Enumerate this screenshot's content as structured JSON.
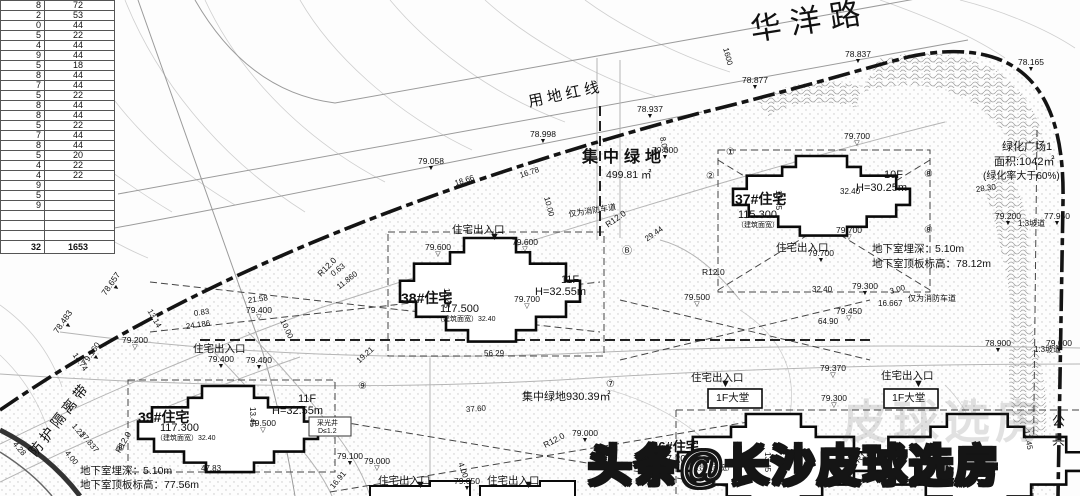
{
  "table": {
    "rows": [
      {
        "a": "8",
        "b": "72"
      },
      {
        "a": "2",
        "b": "53"
      },
      {
        "a": "0",
        "b": "44"
      },
      {
        "a": "5",
        "b": "22"
      },
      {
        "a": "4",
        "b": "44"
      },
      {
        "a": "9",
        "b": "44"
      },
      {
        "a": "5",
        "b": "18"
      },
      {
        "a": "8",
        "b": "44"
      },
      {
        "a": "7",
        "b": "44"
      },
      {
        "a": "5",
        "b": "22"
      },
      {
        "a": "8",
        "b": "44"
      },
      {
        "a": "8",
        "b": "44"
      },
      {
        "a": "5",
        "b": "22"
      },
      {
        "a": "7",
        "b": "44"
      },
      {
        "a": "8",
        "b": "44"
      },
      {
        "a": "5",
        "b": "20"
      },
      {
        "a": "4",
        "b": "22"
      },
      {
        "a": "4",
        "b": "22"
      },
      {
        "a": "9",
        "b": ""
      },
      {
        "a": "5",
        "b": ""
      },
      {
        "a": "9",
        "b": ""
      },
      {
        "a": "",
        "b": ""
      },
      {
        "a": "",
        "b": ""
      },
      {
        "a": "",
        "b": ""
      },
      {
        "a": "32",
        "b": "1653",
        "cls": "tt"
      }
    ]
  },
  "labels": [
    {
      "t": "华洋路",
      "x": 748,
      "y": 14,
      "s": 31,
      "rot": -9,
      "w": 9
    },
    {
      "t": "用地红线",
      "x": 527,
      "y": 95,
      "s": 15,
      "rot": -12,
      "w": 4
    },
    {
      "t": "防护隔离带",
      "x": 26,
      "y": 450,
      "s": 14,
      "rot": -52,
      "w": 4
    },
    {
      "t": "集中绿地",
      "x": 582,
      "y": 149,
      "s": 16,
      "w": 5,
      "cls": "bd"
    },
    {
      "t": "499.81 ㎡",
      "x": 606,
      "y": 170,
      "s": 10.5
    },
    {
      "t": "集中绿地930.39㎡",
      "x": 522,
      "y": 392,
      "s": 11
    },
    {
      "t": "绿化广场1",
      "x": 1002,
      "y": 142,
      "s": 11
    },
    {
      "t": "面积:1042㎡",
      "x": 994,
      "y": 157,
      "s": 11
    },
    {
      "t": "(绿化率大于60%)",
      "x": 983,
      "y": 172,
      "s": 10
    },
    {
      "t": "37#住宅",
      "x": 735,
      "y": 192,
      "s": 14,
      "cls": "bd"
    },
    {
      "t": "115.300",
      "x": 738,
      "y": 210,
      "s": 11
    },
    {
      "t": "（建筑面宽）",
      "x": 737,
      "y": 222,
      "s": 7
    },
    {
      "t": "10F",
      "x": 884,
      "y": 170,
      "s": 11
    },
    {
      "t": "H=30.25m",
      "x": 856,
      "y": 183,
      "s": 11
    },
    {
      "t": "38#住宅",
      "x": 401,
      "y": 291,
      "s": 14,
      "cls": "bd"
    },
    {
      "t": "117.500",
      "x": 440,
      "y": 304,
      "s": 11
    },
    {
      "t": "（建筑面宽）32.40",
      "x": 436,
      "y": 316,
      "s": 7
    },
    {
      "t": "11F",
      "x": 561,
      "y": 275,
      "s": 11
    },
    {
      "t": "H=32.55m",
      "x": 535,
      "y": 287,
      "s": 11
    },
    {
      "t": "39#住宅",
      "x": 138,
      "y": 410,
      "s": 14,
      "cls": "bd"
    },
    {
      "t": "117.300",
      "x": 160,
      "y": 423,
      "s": 11
    },
    {
      "t": "（建筑面宽）32.40",
      "x": 156,
      "y": 435,
      "s": 7
    },
    {
      "t": "11F",
      "x": 298,
      "y": 394,
      "s": 11
    },
    {
      "t": "H=32.55m",
      "x": 272,
      "y": 406,
      "s": 11
    },
    {
      "t": "36#住宅",
      "x": 651,
      "y": 440,
      "s": 13,
      "cls": "bd"
    },
    {
      "t": "117.200",
      "x": 656,
      "y": 455,
      "s": 10
    },
    {
      "t": "（建筑面宽）",
      "x": 692,
      "y": 465,
      "s": 7
    },
    {
      "t": "住宅出入口",
      "x": 452,
      "y": 225,
      "s": 10.5
    },
    {
      "t": "住宅出入口",
      "x": 776,
      "y": 243,
      "s": 10.5
    },
    {
      "t": "住宅出入口",
      "x": 691,
      "y": 373,
      "s": 10.5
    },
    {
      "t": "住宅出入口",
      "x": 881,
      "y": 371,
      "s": 10.5
    },
    {
      "t": "住宅出入口",
      "x": 378,
      "y": 476,
      "s": 10.5
    },
    {
      "t": "住宅出入口",
      "x": 487,
      "y": 476,
      "s": 10.5
    },
    {
      "t": "住宅出入口",
      "x": 193,
      "y": 344,
      "s": 10.5
    },
    {
      "t": "1F大堂",
      "x": 716,
      "y": 393,
      "s": 10.5
    },
    {
      "t": "1F大堂",
      "x": 892,
      "y": 393,
      "s": 10.5
    },
    {
      "t": "地下室埋深：5.10m",
      "x": 872,
      "y": 244,
      "s": 10.5
    },
    {
      "t": "地下室顶板标高：78.12m",
      "x": 872,
      "y": 259,
      "s": 10.5
    },
    {
      "t": "地下室埋深：5.10m",
      "x": 80,
      "y": 466,
      "s": 10.5
    },
    {
      "t": "地下室顶板标高：77.56m",
      "x": 80,
      "y": 480,
      "s": 10.5
    },
    {
      "t": "仅为消防车道",
      "x": 568,
      "y": 211,
      "s": 8,
      "rot": -9
    },
    {
      "t": "仅为消防车道",
      "x": 908,
      "y": 295,
      "s": 8
    },
    {
      "t": "采光井",
      "x": 317,
      "y": 420,
      "s": 7
    },
    {
      "t": "D≤1.2",
      "x": 318,
      "y": 428,
      "s": 7
    },
    {
      "t": "公共",
      "x": 1050,
      "y": 414,
      "s": 13,
      "w": 6,
      "cls": "v"
    },
    {
      "t": "1:3坡道",
      "x": 1018,
      "y": 220,
      "s": 8
    },
    {
      "t": "1:3坡道",
      "x": 1034,
      "y": 346,
      "s": 8
    },
    {
      "t": "R12.0",
      "x": 604,
      "y": 222,
      "s": 8.5,
      "rot": -35
    },
    {
      "t": "R12.0",
      "x": 702,
      "y": 268,
      "s": 8.5
    },
    {
      "t": "R12.0",
      "x": 542,
      "y": 442,
      "s": 8.5,
      "rot": -28
    },
    {
      "t": "R12.0",
      "x": 854,
      "y": 458,
      "s": 8.5,
      "rot": -40
    },
    {
      "t": "R12.0",
      "x": 316,
      "y": 272,
      "s": 8.5,
      "rot": -45
    },
    {
      "t": "R12.0",
      "x": 114,
      "y": 450,
      "s": 8.5,
      "rot": -60
    }
  ],
  "markers": [
    {
      "v": "78.837",
      "x": 845,
      "y": 50,
      "g": "▼"
    },
    {
      "v": "78.877",
      "x": 742,
      "y": 76,
      "g": "▼"
    },
    {
      "v": "78.165",
      "x": 1018,
      "y": 58,
      "g": "▼"
    },
    {
      "v": "78.937",
      "x": 637,
      "y": 105,
      "g": "▼"
    },
    {
      "v": "78.998",
      "x": 530,
      "y": 130,
      "g": "▼"
    },
    {
      "v": "79.058",
      "x": 418,
      "y": 157,
      "g": "▼"
    },
    {
      "v": "78.657",
      "x": 100,
      "y": 292,
      "g": "▼",
      "rot": -55
    },
    {
      "v": "78.483",
      "x": 52,
      "y": 330,
      "g": "▼",
      "rot": -55
    },
    {
      "v": "79.160",
      "x": 80,
      "y": 362,
      "g": "▼",
      "rot": -55
    },
    {
      "v": "79.200",
      "x": 122,
      "y": 336,
      "g": "▽"
    },
    {
      "v": "79.700",
      "x": 844,
      "y": 132,
      "g": "▽"
    },
    {
      "v": "79.600",
      "x": 652,
      "y": 146,
      "g": "▼"
    },
    {
      "v": "79.600",
      "x": 425,
      "y": 243,
      "g": "▽"
    },
    {
      "v": "79.600",
      "x": 512,
      "y": 238,
      "g": "▽"
    },
    {
      "v": "79.700",
      "x": 836,
      "y": 226,
      "g": "▽"
    },
    {
      "v": "79.700",
      "x": 808,
      "y": 249,
      "g": "▼"
    },
    {
      "v": "79.700",
      "x": 514,
      "y": 295,
      "g": "▽"
    },
    {
      "v": "79.500",
      "x": 684,
      "y": 293,
      "g": "▽"
    },
    {
      "v": "79.300",
      "x": 852,
      "y": 282,
      "g": "▼"
    },
    {
      "v": "79.450",
      "x": 836,
      "y": 307,
      "g": "▽"
    },
    {
      "v": "79.370",
      "x": 820,
      "y": 364,
      "g": "▽"
    },
    {
      "v": "79.300",
      "x": 821,
      "y": 394,
      "g": "▽"
    },
    {
      "v": "79.400",
      "x": 246,
      "y": 306,
      "g": "▽"
    },
    {
      "v": "79.400",
      "x": 208,
      "y": 355,
      "g": "▼"
    },
    {
      "v": "79.400",
      "x": 246,
      "y": 356,
      "g": "▼"
    },
    {
      "v": "79.500",
      "x": 250,
      "y": 419,
      "g": "▽"
    },
    {
      "v": "79.100",
      "x": 337,
      "y": 452,
      "g": "▼"
    },
    {
      "v": "79.000",
      "x": 364,
      "y": 457,
      "g": "▽"
    },
    {
      "v": "79.050",
      "x": 454,
      "y": 477,
      "g": "▼"
    },
    {
      "v": "79.000",
      "x": 572,
      "y": 429,
      "g": "▼"
    },
    {
      "v": "79.200",
      "x": 995,
      "y": 212,
      "g": "▼"
    },
    {
      "v": "77.950",
      "x": 1044,
      "y": 212,
      "g": "▼"
    },
    {
      "v": "78.900",
      "x": 985,
      "y": 339,
      "g": "▼"
    },
    {
      "v": "79.000",
      "x": 1046,
      "y": 339,
      "g": "▼"
    },
    {
      "v": "",
      "x": 489,
      "y": 233,
      "g": "▼",
      "cls": "etr"
    },
    {
      "v": "",
      "x": 720,
      "y": 380,
      "g": "▼",
      "cls": "etr"
    },
    {
      "v": "",
      "x": 913,
      "y": 380,
      "g": "▼",
      "cls": "etr"
    },
    {
      "v": "",
      "x": 415,
      "y": 481,
      "g": "▼",
      "cls": "etr"
    },
    {
      "v": "",
      "x": 523,
      "y": 481,
      "g": "▼",
      "cls": "etr"
    }
  ],
  "dims": [
    {
      "t": "1600",
      "x": 725,
      "y": 44,
      "rot": 75
    },
    {
      "t": "18.66",
      "x": 455,
      "y": 180,
      "rot": -18
    },
    {
      "t": "16.78",
      "x": 520,
      "y": 172,
      "rot": -18
    },
    {
      "t": "10.00",
      "x": 546,
      "y": 193,
      "rot": 75
    },
    {
      "t": "8.00",
      "x": 662,
      "y": 133,
      "rot": 80
    },
    {
      "t": "28.30",
      "x": 976,
      "y": 186,
      "rot": -8
    },
    {
      "t": "21.58",
      "x": 248,
      "y": 297,
      "rot": -8
    },
    {
      "t": "24.186",
      "x": 186,
      "y": 323,
      "rot": -8
    },
    {
      "t": "0.83",
      "x": 194,
      "y": 310,
      "rot": -8
    },
    {
      "t": "13.14",
      "x": 149,
      "y": 306,
      "rot": 60
    },
    {
      "t": "11.860",
      "x": 338,
      "y": 284,
      "rot": -38
    },
    {
      "t": "0.63",
      "x": 332,
      "y": 271,
      "rot": -38
    },
    {
      "t": "19.21",
      "x": 358,
      "y": 358,
      "rot": -42
    },
    {
      "t": "14.74",
      "x": 74,
      "y": 350,
      "rot": 55
    },
    {
      "t": "1.21",
      "x": 73,
      "y": 421,
      "rot": 50
    },
    {
      "t": "37.837",
      "x": 81,
      "y": 429,
      "rot": 50
    },
    {
      "t": "4.00",
      "x": 66,
      "y": 448,
      "rot": 50
    },
    {
      "t": "4.28",
      "x": 14,
      "y": 439,
      "rot": 50
    },
    {
      "t": "37.60",
      "x": 466,
      "y": 406,
      "rot": -4
    },
    {
      "t": "56.29",
      "x": 484,
      "y": 350
    },
    {
      "t": "47.83",
      "x": 201,
      "y": 465
    },
    {
      "t": "13.45",
      "x": 778,
      "y": 186,
      "rot": 90
    },
    {
      "t": "13.45",
      "x": 446,
      "y": 284,
      "rot": 90
    },
    {
      "t": "13.45",
      "x": 252,
      "y": 403,
      "rot": 90
    },
    {
      "t": "13.45",
      "x": 767,
      "y": 448,
      "rot": 90
    },
    {
      "t": "32.40",
      "x": 840,
      "y": 188
    },
    {
      "t": "32.40",
      "x": 812,
      "y": 286
    },
    {
      "t": "16.667",
      "x": 878,
      "y": 300
    },
    {
      "t": "3.00",
      "x": 890,
      "y": 288,
      "rot": -15
    },
    {
      "t": "64.90",
      "x": 818,
      "y": 318
    },
    {
      "t": "29.44",
      "x": 646,
      "y": 236,
      "rot": -35
    },
    {
      "t": "10.00",
      "x": 282,
      "y": 316,
      "rot": 65
    },
    {
      "t": "12.45",
      "x": 1026,
      "y": 426,
      "rot": 80
    },
    {
      "t": "16.91",
      "x": 332,
      "y": 484,
      "rot": -50
    },
    {
      "t": "4.00",
      "x": 460,
      "y": 459,
      "rot": 70
    }
  ],
  "bubbles": [
    {
      "t": "①",
      "x": 726,
      "y": 148
    },
    {
      "t": "②",
      "x": 706,
      "y": 172
    },
    {
      "t": "⑧",
      "x": 924,
      "y": 170
    },
    {
      "t": "⑧",
      "x": 924,
      "y": 226
    },
    {
      "t": "⑨",
      "x": 358,
      "y": 382
    },
    {
      "t": "⑦",
      "x": 606,
      "y": 380
    },
    {
      "t": "Ⓑ",
      "x": 622,
      "y": 247
    },
    {
      "t": "⑧",
      "x": 116,
      "y": 444
    }
  ],
  "watermark": {
    "main": "头条@长沙皮球选房",
    "ghost": "皮球选房"
  }
}
